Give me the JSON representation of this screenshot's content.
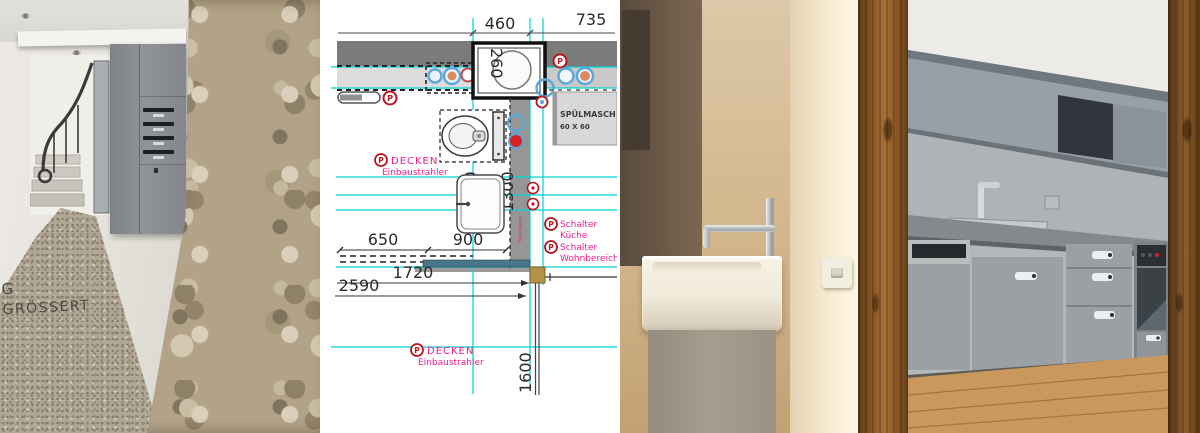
{
  "hallway": {
    "caption": {
      "line1": "G",
      "line2": "GRÖSSERT"
    }
  },
  "plan": {
    "dims": {
      "width_top": "460",
      "width_right": "735",
      "washer_depth": "260",
      "bath_length": "1370",
      "wall_length": "1300",
      "counter_left": "650",
      "counter_right": "900",
      "kitchen_run": "1720",
      "total_run": "2590",
      "island_depth": "1600"
    },
    "labels": {
      "marker_letter": "P",
      "ceiling_spots_1": {
        "title": "DECKEN",
        "subtitle": "Einbaustrahler"
      },
      "ceiling_spots_2": {
        "title": "DECKEN",
        "subtitle": "Einbaustrahler"
      },
      "switch_kitchen": {
        "title": "Schalter",
        "subtitle": "Küche"
      },
      "switch_living": {
        "title": "Schalter",
        "subtitle": "Wohnbereich"
      },
      "dishwasher": {
        "line1": "SPÜLMASCH",
        "line2": "60 X 60"
      },
      "wall_socket_vertical": "Steckdose"
    },
    "colors": {
      "grid_cyan": "#00d2d2",
      "annotation_pink": "#ec1e8e",
      "marker_red": "#b5161f",
      "symbol_blue": "#5aa7d9",
      "wall_gray": "#7b7b7b",
      "post_tan": "#b3924a"
    }
  }
}
